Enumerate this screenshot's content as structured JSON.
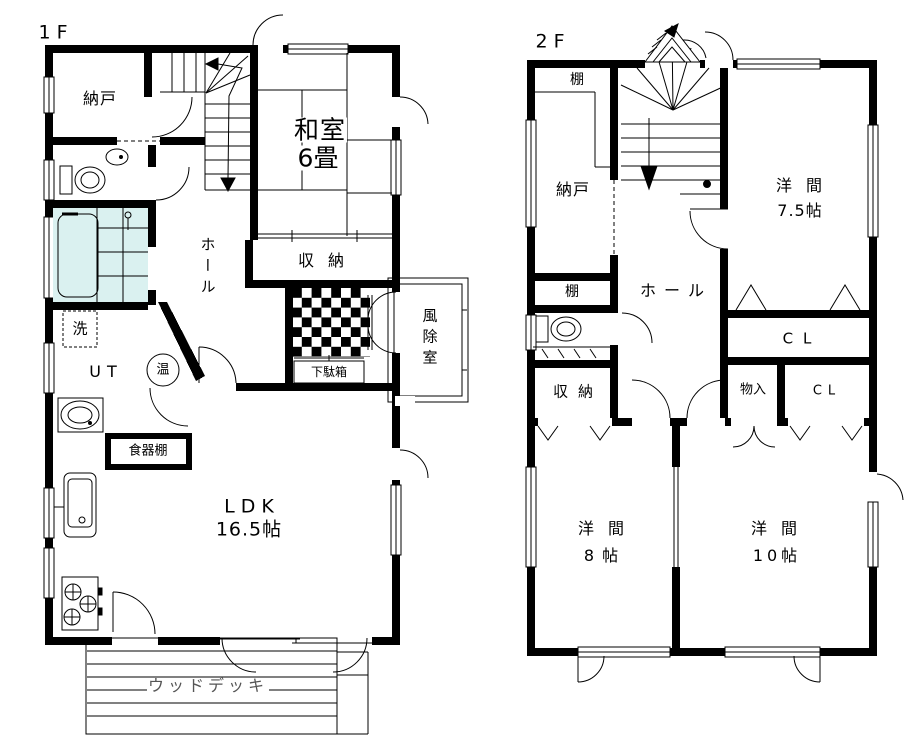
{
  "colors": {
    "wall": "#000000",
    "bath_tile": "#daf1f0",
    "line": "#000000",
    "deck_text": "#555555",
    "background": "#ffffff"
  },
  "floor1": {
    "label": "1F",
    "rooms": {
      "nando": "納戸",
      "washitsu": "和室",
      "washitsu_size": "6畳",
      "shuno": "収納",
      "hall": "ホール",
      "fujoshitsu": "風除室",
      "getabako": "下駄箱",
      "sen": "洗",
      "ut": "UT",
      "on": "温",
      "shokkidana": "食器棚",
      "ldk": "LDK",
      "ldk_size": "16.5帖",
      "wood_deck": "ウッドデッキ"
    }
  },
  "floor2": {
    "label": "2F",
    "rooms": {
      "tana_top": "棚",
      "nando": "納戸",
      "tana_mid": "棚",
      "hall": "ホール",
      "yoma75": "洋間",
      "yoma75_size": "7.5帖",
      "cl_upper": "CL",
      "monoire": "物入",
      "cl_lower": "CL",
      "shuno": "収納",
      "yoma8": "洋間",
      "yoma8_size": "8帖",
      "yoma10": "洋間",
      "yoma10_size": "10帖"
    }
  }
}
